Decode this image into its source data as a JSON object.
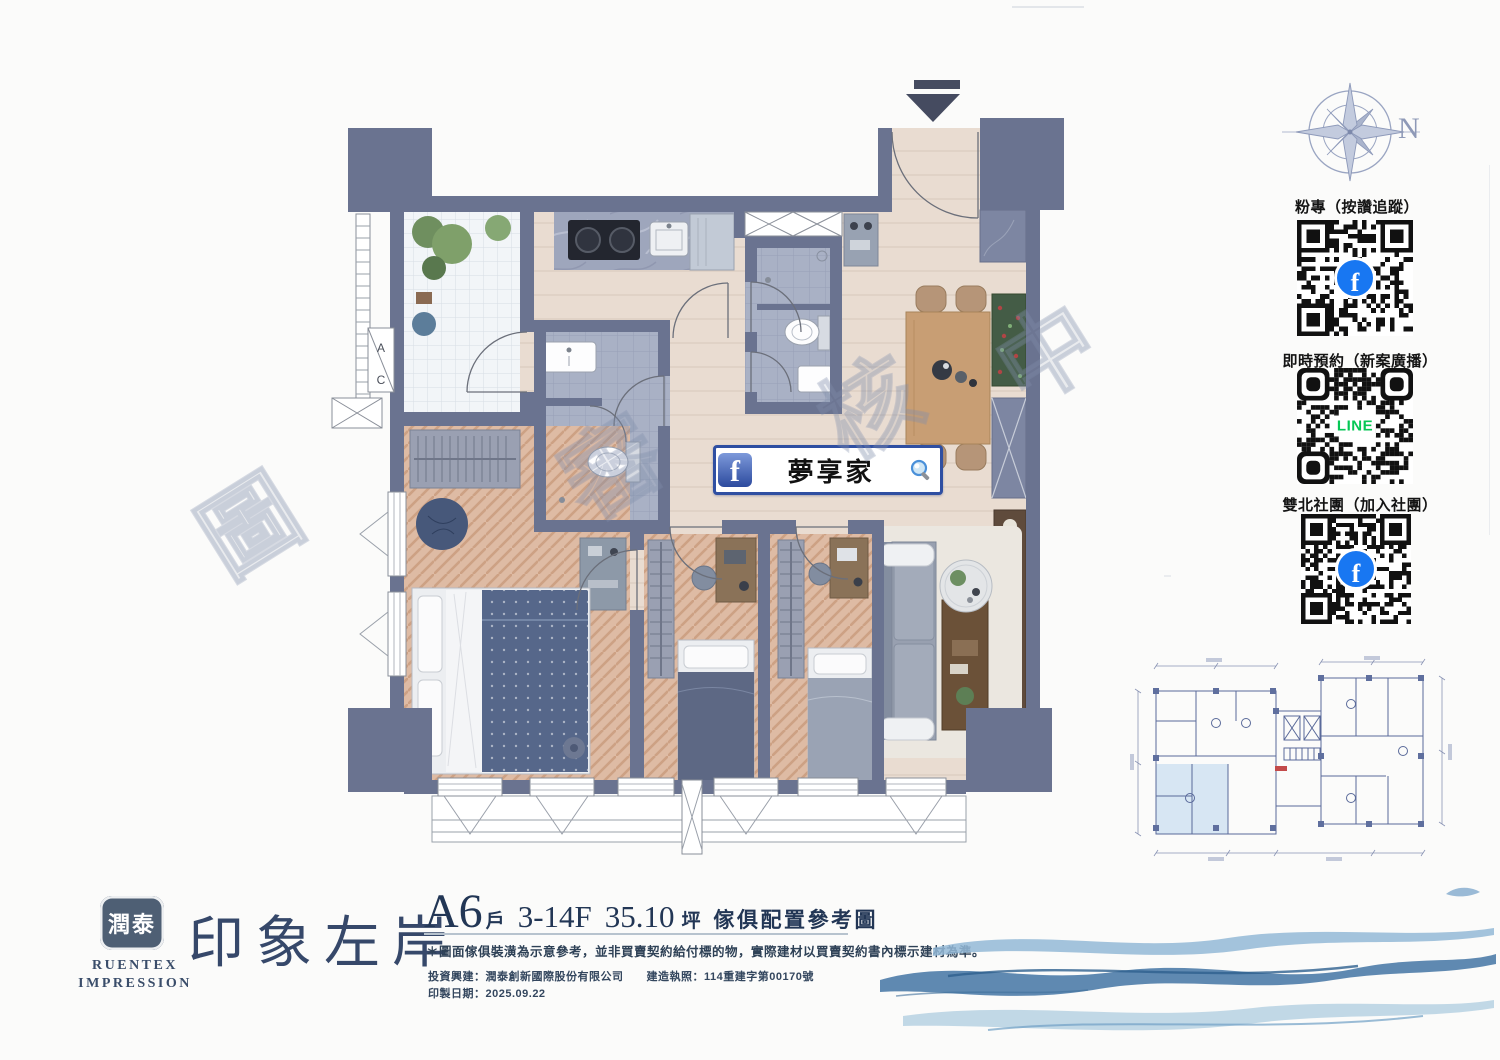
{
  "watermark": {
    "chars": [
      "圖",
      "審",
      "核",
      "中"
    ]
  },
  "compass": {
    "n": "N"
  },
  "qr_sections": [
    {
      "label": "粉專（按讚追蹤）",
      "icon": "facebook-qr",
      "center": "f"
    },
    {
      "label": "即時預約（新案廣播）",
      "icon": "line-qr",
      "center": "LINE"
    },
    {
      "label": "雙北社團（加入社團）",
      "icon": "facebook-qr",
      "center": "f"
    }
  ],
  "banner": {
    "text": "夢享家"
  },
  "plan": {
    "ac_top": "A",
    "ac_bottom": "C"
  },
  "logo": {
    "badge": "潤泰",
    "name1": "RUENTEX",
    "name2": "IMPRESSION",
    "title": "印象左岸"
  },
  "unit_info": {
    "unit": "A6",
    "unit_suffix": "戶",
    "floors": "3-14F",
    "area": "35.10",
    "area_unit": "坪",
    "caption": "傢俱配置參考圖"
  },
  "disclaimer": {
    "text": "＊圖面傢俱裝潢為示意參考，並非買賣契約給付標的物，實際建材以買賣契約書內標示建材為準。"
  },
  "footer": {
    "line1": "投資興建：潤泰創新國際股份有限公司　　建造執照：114重建字第00170號",
    "line2": "印製日期：2025.09.22"
  },
  "colors": {
    "facebook_blue": "#1877f2",
    "line_green": "#06c755",
    "navy_text": "#2e4156",
    "wall_slate": "#6a7390",
    "wave_blue": "#4e7ca8",
    "keyplan_highlight": "#d7e6f3"
  }
}
